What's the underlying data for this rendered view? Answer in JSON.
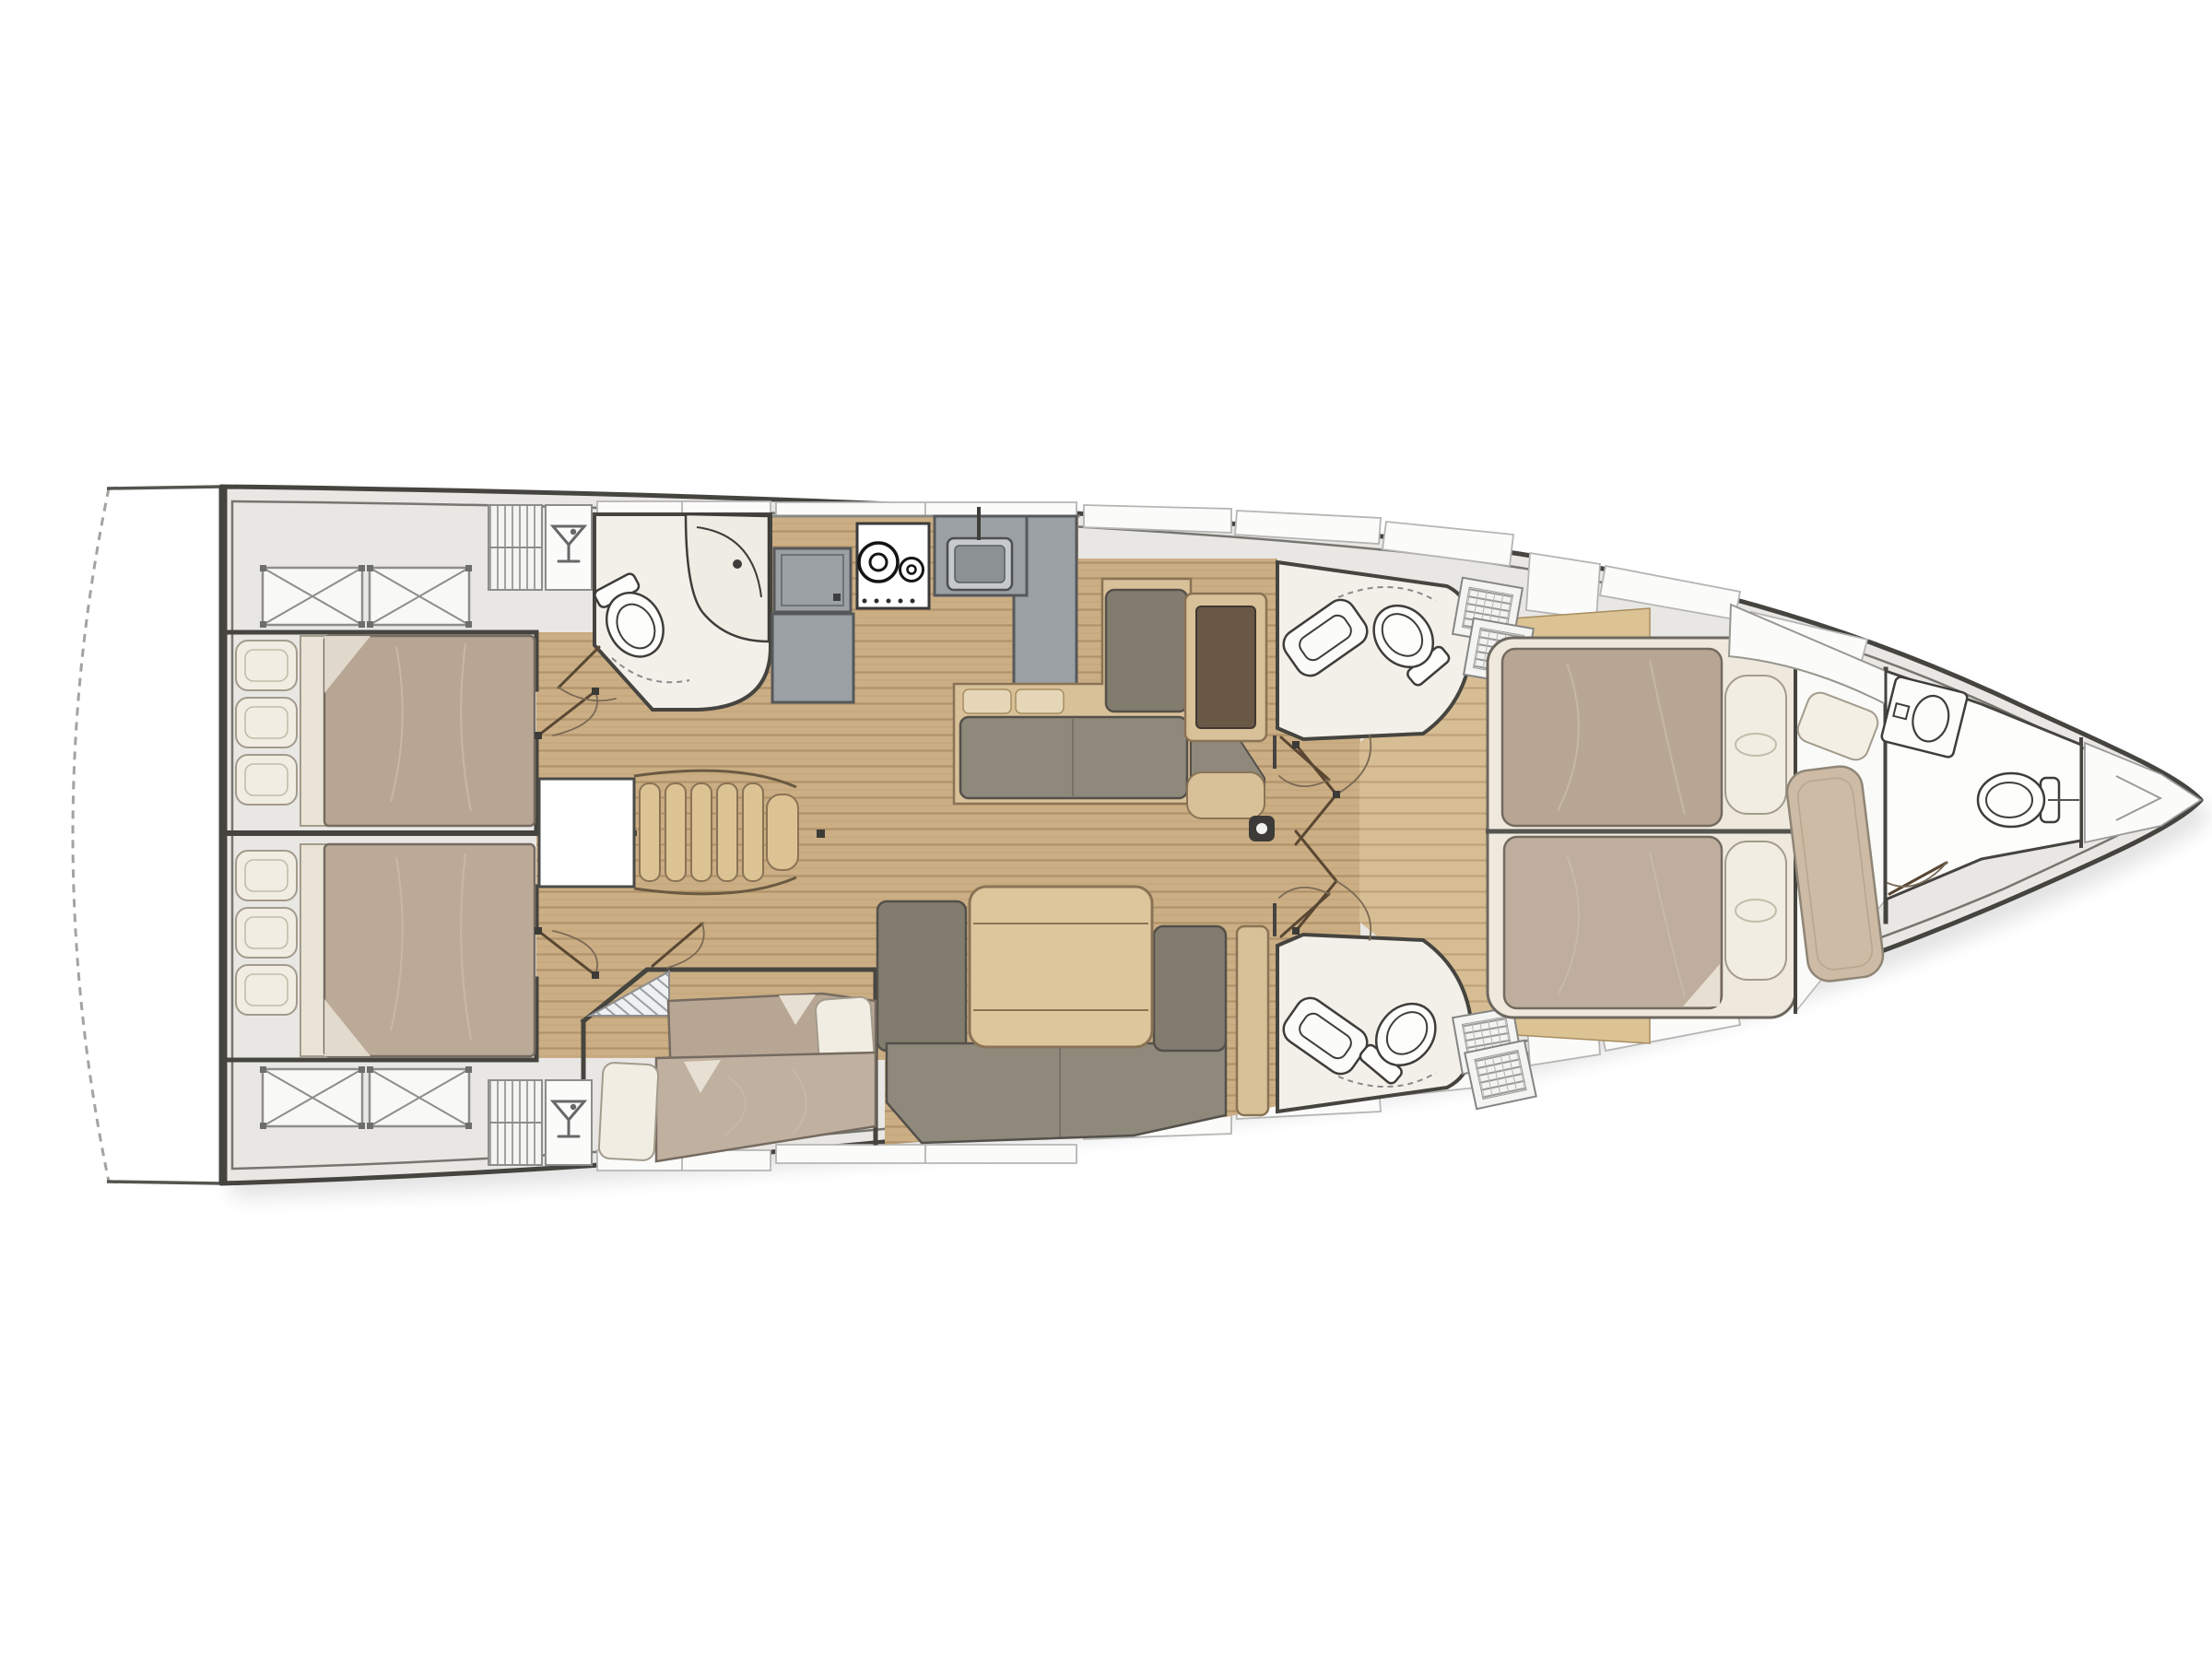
{
  "plan": {
    "type": "yacht-interior-floor-plan",
    "view": "top-down",
    "bow_direction": "right",
    "stern_direction": "left",
    "rooms": {
      "swim_platform": {
        "label": "Fold-down swim platform (stern)"
      },
      "aft_cabin_port": {
        "label": "Aft double cabin, port side"
      },
      "aft_cabin_starboard": {
        "label": "Aft double cabin, starboard side"
      },
      "aft_head": {
        "label": "Aft bathroom with toilet and vanity"
      },
      "galley": {
        "label": "Galley with fridge, two-burner stove and sink"
      },
      "nav_settee": {
        "label": "L-settee with chart table"
      },
      "salon": {
        "label": "Salon with settee and folding table"
      },
      "companionway": {
        "label": "Companionway stairs and engine hatch"
      },
      "mid_cabin": {
        "label": "Midship cabin with two single berths"
      },
      "head_forward_port": {
        "label": "Forward bathroom, port side"
      },
      "head_forward_starboard": {
        "label": "Forward bathroom, starboard side"
      },
      "owner_cabin": {
        "label": "Owner's cabin with island double berth and bench"
      },
      "bow_head": {
        "label": "Bow bathroom with sink and toilet"
      },
      "anchor_locker": {
        "label": "Anchor locker at bow"
      }
    },
    "fixtures": {
      "toilets": 4,
      "sinks": 3,
      "stove_burners": 2,
      "deck_hatches_x_marked": 4,
      "grated_deck_hatches": 4,
      "hanging_lockers": 2,
      "wet_bar_glass_icons": 2,
      "double_berths": 3,
      "single_berths": 2,
      "mast": 1,
      "door_swings": 10
    },
    "colors": {
      "background": "#ffffff",
      "hull_outline": "#45443f",
      "inner_hull_line": "#76756f",
      "deck": "#e8e7e4",
      "deck_panel": "#fbfbfa",
      "teak_floor": "#cbae84",
      "teak_plank_line": "#b0936a",
      "teak_floor_light": "#d7bd93",
      "light_wood": "#dbc393",
      "mattress_taupe": "#b8a695",
      "bedding_cream": "#f1ede2",
      "upholstery_gray": "#8f897c",
      "upholstery_gray_dark": "#827c6f",
      "galley_gray": "#9aa0a4",
      "chart_table_brown": "#6a5847",
      "head_floor": "#f3f0ea",
      "bench_taupe": "#cdbba5",
      "door_line": "#5a4733"
    }
  }
}
